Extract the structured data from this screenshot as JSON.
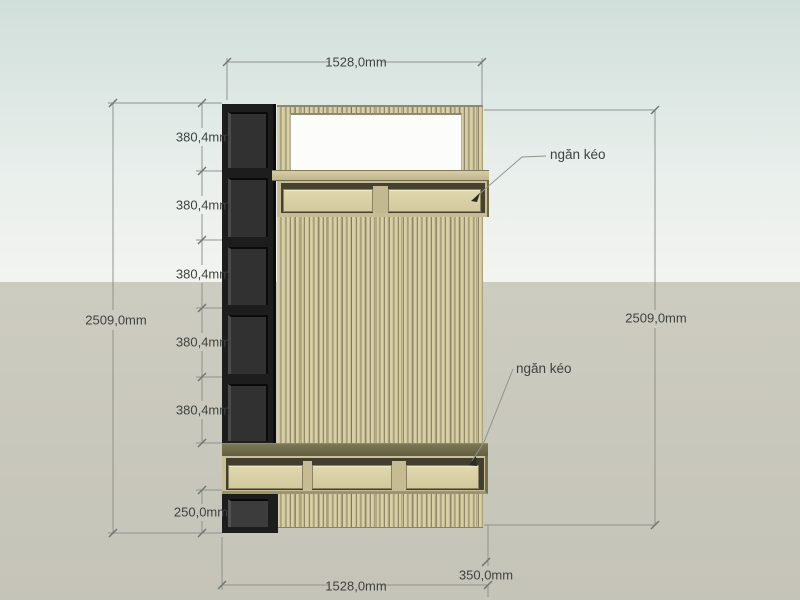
{
  "annotations": {
    "top_width": "1528,0mm",
    "left_height": "2509,0mm",
    "right_height": "2509,0mm",
    "shelf_heights": [
      "380,4mm",
      "380,4mm",
      "380,4mm",
      "380,4mm",
      "380,4mm"
    ],
    "bottom_compartment": "250,0mm",
    "bottom_width": "1528,0mm",
    "bench_depth": "350,0mm",
    "drawer_callout_top": "ngăn kéo",
    "drawer_callout_bottom": "ngăn kéo"
  },
  "colors": {
    "sky_top": "#d1dfdb",
    "sky_bottom": "#f3f4f0",
    "ground": "#c8c7bb",
    "wood_light": "#d7cfa6",
    "wood_line": "#8f8767",
    "bench_top": "#6e6a4a",
    "dark_shelf": "#1d1d1d",
    "dimension_line": "#8f948f",
    "dimension_text": "#3e423f"
  }
}
